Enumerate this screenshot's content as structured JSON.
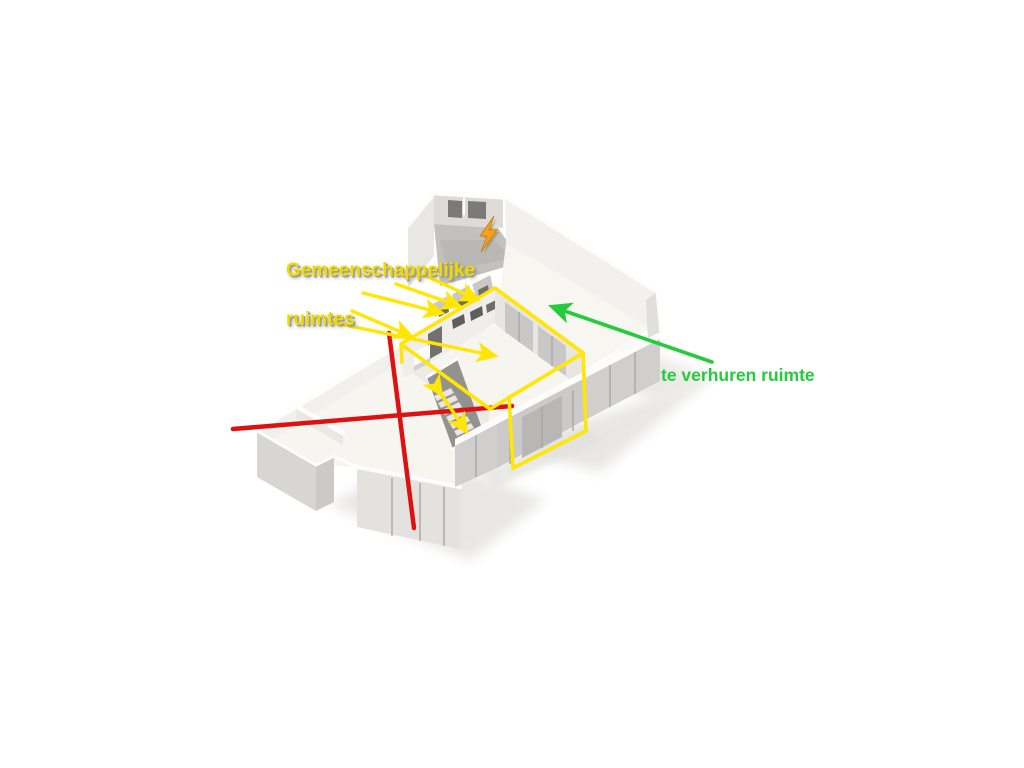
{
  "scene": {
    "background_color": "#ffffff"
  },
  "labels": {
    "common_areas": {
      "line1": "Gemeenschappelijke",
      "line2": "ruimtes",
      "color": "#f0da00"
    },
    "rental": {
      "text": "te verhuren ruimte",
      "color": "#25cb3a"
    }
  },
  "annotations": {
    "red_cross_color": "#dd1111",
    "yellow_outline_color": "#ffe603",
    "yellow_arrow_count": 6,
    "green_arrow_color": "#25cb3a",
    "lightning_icon_color": "#f6a21a"
  }
}
